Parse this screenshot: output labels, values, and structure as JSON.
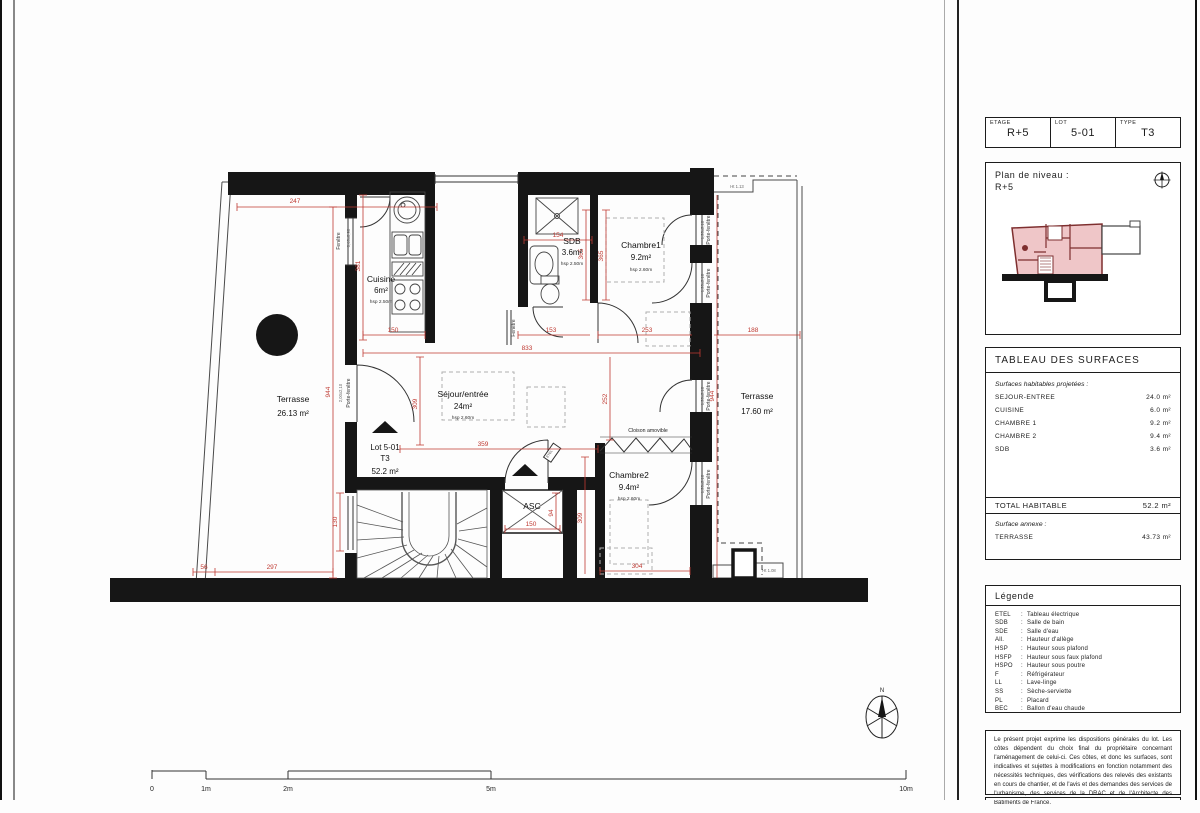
{
  "header_table": {
    "cells": [
      {
        "label": "ETAGE",
        "value": "R+5"
      },
      {
        "label": "LOT",
        "value": "5-01"
      },
      {
        "label": "TYPE",
        "value": "T3"
      }
    ]
  },
  "level_plan": {
    "title_line1": "Plan de niveau :",
    "title_line2": "R+5"
  },
  "surface_table": {
    "title": "TABLEAU DES SURFACES",
    "subtitle": "Surfaces habitables projetées :",
    "rows": [
      [
        "SEJOUR-ENTREE",
        "24.0 m²"
      ],
      [
        "CUISINE",
        "6.0 m²"
      ],
      [
        "CHAMBRE 1",
        "9.2 m²"
      ],
      [
        "CHAMBRE 2",
        "9.4 m²"
      ],
      [
        "SDB",
        "3.6 m²"
      ]
    ],
    "total_label": "TOTAL HABITABLE",
    "total_value": "52.2 m²",
    "annex_subtitle": "Surface annexe :",
    "annex_rows": [
      [
        "TERRASSE",
        "43.73 m²"
      ]
    ]
  },
  "legend": {
    "title": "Légende",
    "items": [
      {
        "abbr": "ETEL",
        "desc": "Tableau électrique"
      },
      {
        "abbr": "SDB",
        "desc": "Salle de bain"
      },
      {
        "abbr": "SDE",
        "desc": "Salle d'eau"
      },
      {
        "abbr": "All.",
        "desc": "Hauteur d'allège"
      },
      {
        "abbr": "HSP",
        "desc": "Hauteur sous plafond"
      },
      {
        "abbr": "HSFP",
        "desc": "Hauteur sous faux plafond"
      },
      {
        "abbr": "HSPO",
        "desc": "Hauteur sous poutre"
      },
      {
        "abbr": "F",
        "desc": "Réfrigérateur"
      },
      {
        "abbr": "LL",
        "desc": "Lave-linge"
      },
      {
        "abbr": "SS",
        "desc": "Sèche-serviette"
      },
      {
        "abbr": "PL",
        "desc": "Placard"
      },
      {
        "abbr": "BEC",
        "desc": "Ballon d'eau chaude"
      }
    ]
  },
  "disclaimer": "Le présent projet exprime les dispositions générales du lot. Les côtes dépendent du choix final du propriétaire concernant l'aménagement de celui-ci. Ces côtes, et donc les surfaces, sont indicatives et sujettes à modifications en fonction notamment des nécessités techniques, des vérifications des relevés des existants en cours de chantier, et de l'avis et des demandes des services de l'urbanisme, des services de la DRAC et de l'Architecte des Bâtiments de France.",
  "plan": {
    "rooms": {
      "terrasse_left": {
        "name": "Terrasse",
        "area": "26.13 m²"
      },
      "cuisine": {
        "name": "Cuisine",
        "area": "6m²",
        "height": "hsp 2.50m"
      },
      "sdb": {
        "name": "SDB",
        "area": "3.6m²",
        "height": "hsp 2.50m"
      },
      "chambre1": {
        "name": "Chambre1",
        "area": "9.2m²",
        "height": "hsp 2.60m"
      },
      "sejour": {
        "name": "Séjour/entrée",
        "area": "24m²",
        "height": "hsp 2.60m"
      },
      "chambre2": {
        "name": "Chambre2",
        "area": "9.4m²",
        "height": "hsp 2.60m"
      },
      "terrasse_right": {
        "name": "Terrasse",
        "area": "17.60 m²"
      },
      "asc": {
        "name": "ASC"
      }
    },
    "lot_marker": {
      "line1": "Lot 5-01",
      "line2": "T3",
      "line3": "52.2 m²"
    },
    "labels": {
      "porte_fenetre": "Porte-fenêtre",
      "fenetre": "Fenêtre",
      "cloison": "Cloison amovible",
      "etel": "ETEL",
      "window_size": "0,40x0,90",
      "pf_size": "1,20x2,10",
      "pf_size_left": "2,00x2,10",
      "ht113": "Ht 1.13",
      "ht108": "Ht 1.08",
      "north": "N"
    },
    "dims": {
      "top": "247",
      "left_v": "944",
      "cuisine_h": "381",
      "cuisine_w": "150",
      "interior_w": "833",
      "sdb_w": "154",
      "sdb_h1": "365",
      "sdb_h2": "365",
      "hall_w": "153",
      "ch1_w": "253",
      "ter_r_w": "188",
      "right_v": "944",
      "sejour_w": "359",
      "sejour_h": "309",
      "corridor_h": "309",
      "ch2_h": "252",
      "ch2_w": "304",
      "asc_w": "150",
      "asc_h": "94",
      "bottom_a": "56",
      "bottom_b": "297",
      "stair_h": "130"
    },
    "scale": {
      "t0": "0",
      "t1": "1m",
      "t2": "2m",
      "t5": "5m",
      "t10": "10m"
    }
  }
}
